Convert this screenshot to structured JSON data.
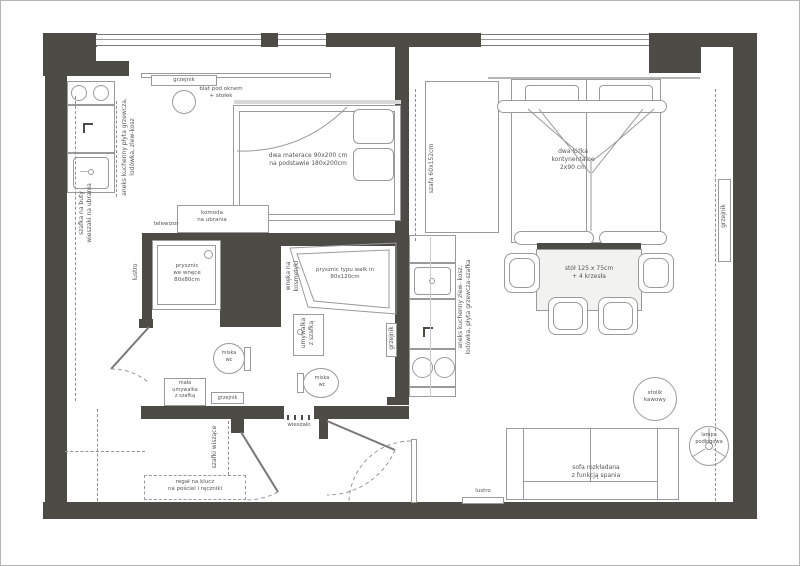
{
  "colors": {
    "wall": "#4c4b46",
    "line": "#9a9a9a",
    "text": "#555555"
  },
  "labels": {
    "radiator_window": "grzejnik",
    "worktop_window": "blat pod oknem\n+ stołek",
    "kitchen_left": "aneks kuchenny płyta grzewcza,\nlodówka, zlew-kosz",
    "shoe_cabinet": "szafka na buty\nwieszaki na ubrania",
    "bed_left": "dwa materace 90x200 cm\nna podstawie 180x200cm",
    "wardrobe": "szafa 60x152cm",
    "bed_right": "dwa łóżka\nkontynentalne\n2x90 cm",
    "tv_wall": "tv wieszany na ściance drewnianej",
    "table": "stół 125 x 75cm\n+ 4 krzesła",
    "tv": "telewizor",
    "dresser": "komoda\nna ubrania",
    "mirror_left": "lustro",
    "shower_niche": "prysznic\nwe wnęce\n80x80cm",
    "cosmetics_niche": "wnęka na kosmetyki",
    "walkin_shower": "prysznic typu walk in\n80x120cm",
    "sink_center": "umywalka\nz szafką",
    "wc_left": "miska\nwc",
    "sink_small": "mała\numywalka\nz szafką",
    "radiator_bath_left": "grzejnik",
    "radiator_bath_center": "grzejnik",
    "wc_center": "miska\nwc",
    "hooks": "wieszaki",
    "hanging_cabinets": "szafki wiszące",
    "shelf_hall": "regał na klucz\nna pościel i ręczniki",
    "mirror_bottom": "lustro",
    "sofa": "sofa rozkładana\nz funkcją spania",
    "coffee_table": "stolik\nkawowy",
    "floor_lamp": "lampa\npodłogowa",
    "radiator_right": "grzejnik",
    "kitchen_right": "aneks kuchenny zlew- kosz,\nlodówka, płyta grzewcza-szafka"
  }
}
